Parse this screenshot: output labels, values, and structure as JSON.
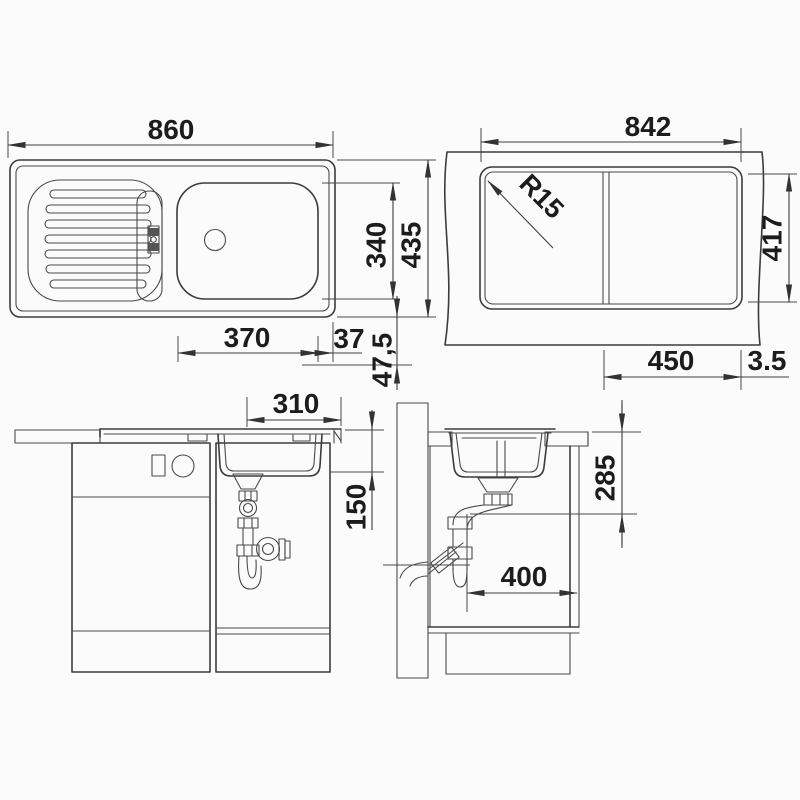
{
  "drawing": {
    "background": "#fbfbfb",
    "line_color": "#3c3c3c",
    "text_color": "#1c1c1c",
    "units": "mm",
    "views": {
      "sink_top": {
        "dims": {
          "overall_width": "860",
          "bowl_depth": "340",
          "overall_depth": "435",
          "bowl_width": "370",
          "edge_gap": "37",
          "rim_offset": "47,5"
        }
      },
      "cutout_plan": {
        "dims": {
          "cutout_width": "842",
          "corner_radius": "R15",
          "cutout_depth": "417",
          "offset_450": "450",
          "edge_clearance": "3.5"
        }
      },
      "cabinet_front": {
        "dims": {
          "bowl_width": "310",
          "bowl_depth": "150"
        }
      },
      "cabinet_side": {
        "dims": {
          "outlet_height": "285",
          "depth_clearance": "400"
        }
      }
    }
  }
}
